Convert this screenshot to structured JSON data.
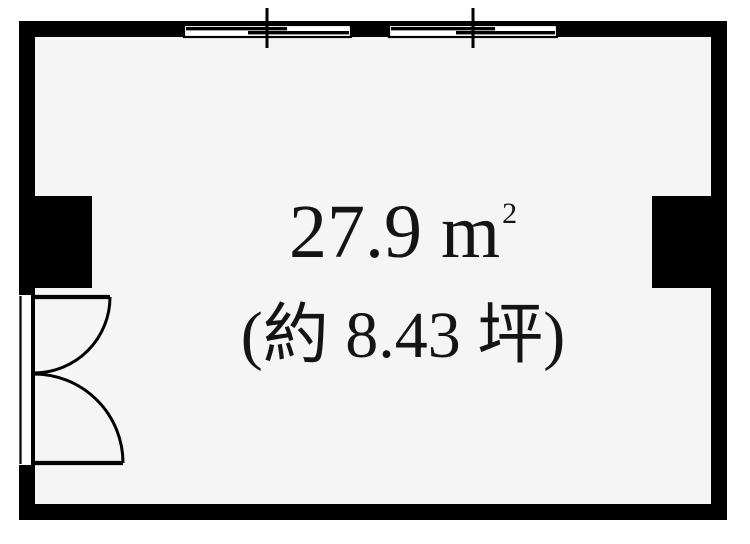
{
  "colors": {
    "wall": "#000000",
    "floor": "#f5f5f5",
    "background": "#ffffff",
    "text": "#141414"
  },
  "labels": {
    "area_m2": "27.9 m",
    "area_m2_sup": "2",
    "area_tsubo": "(約 8.43 坪)"
  }
}
